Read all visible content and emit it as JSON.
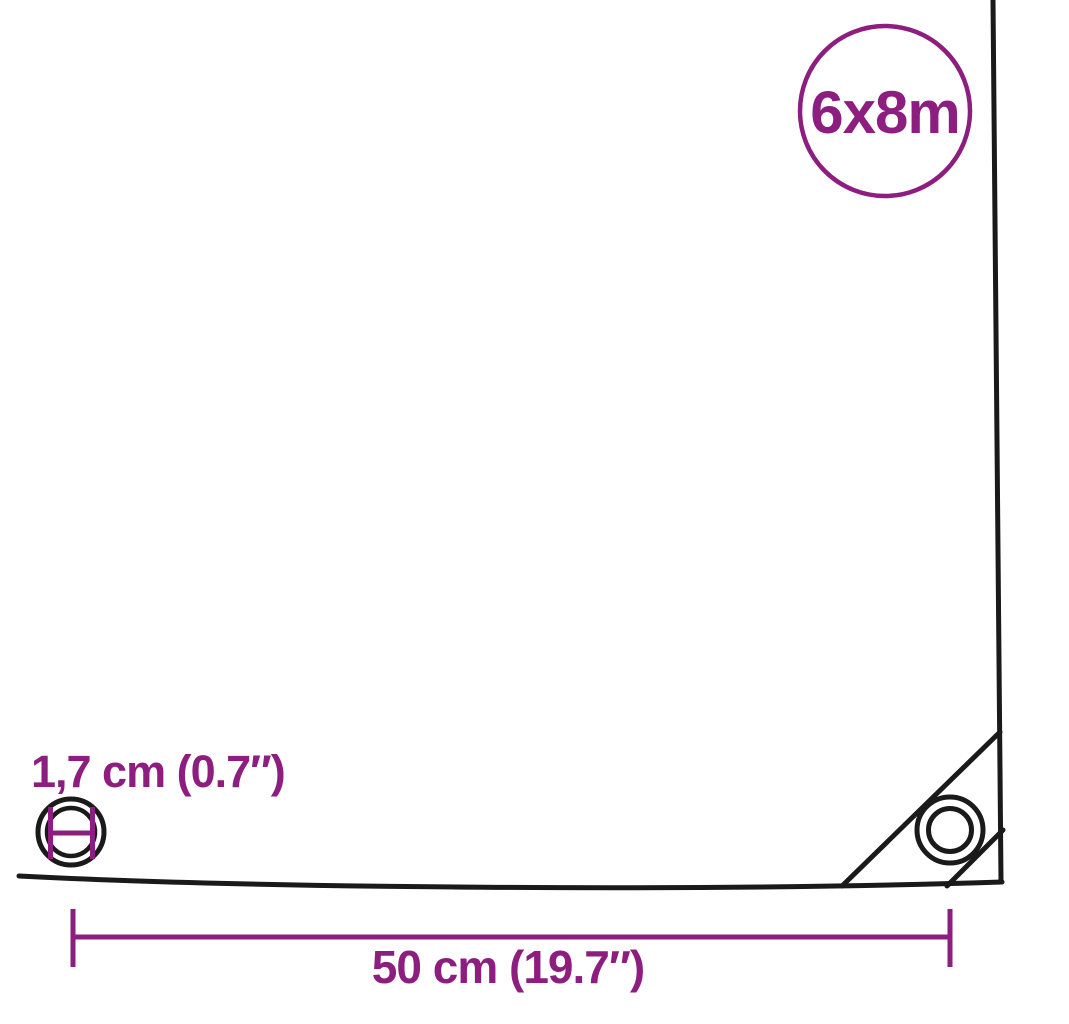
{
  "diagram": {
    "badge": {
      "label": "6x8m"
    },
    "labels": {
      "eyelet_diameter": "1,7 cm (0.7″)",
      "eyelet_spacing": "50 cm (19.7″)"
    },
    "icons": {
      "corner_eyelet": "corner-eyelet-icon",
      "eyelet_diameter_marker": "eyelet-diameter-icon"
    }
  },
  "colors": {
    "accent_purple": "#8D1D7E",
    "line_black": "#1A1A1A",
    "background": "#FFFFFF"
  }
}
